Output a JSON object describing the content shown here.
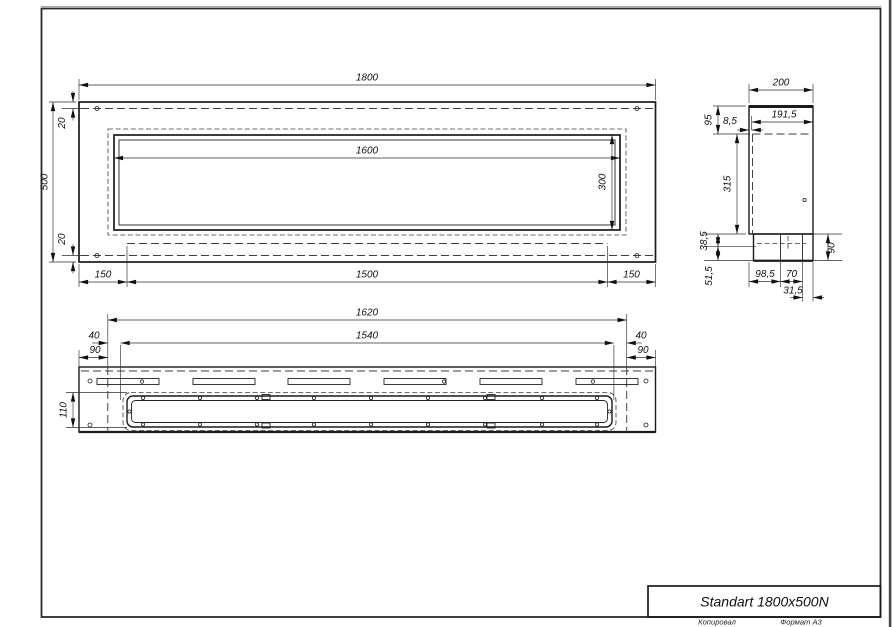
{
  "drawing": {
    "front_view": {
      "overall_width": "1800",
      "overall_height": "500",
      "opening_width": "1600",
      "opening_height": "300",
      "top_inset": "20",
      "bottom_inset": "20",
      "left_margin": "150",
      "center_span": "1500",
      "right_margin": "150"
    },
    "side_view": {
      "depth": "200",
      "inner_depth": "191,5",
      "front_lip": "8,5",
      "top_section": "95",
      "middle_section": "315",
      "ledge_height": "38,5",
      "base_height": "51,5",
      "tray_height": "90",
      "base_a": "98,5",
      "base_b": "70",
      "base_c": "31,5"
    },
    "bottom_view": {
      "mount_width": "1620",
      "inner_width": "1540",
      "left_offset": "40",
      "left_cap": "90",
      "right_offset": "40",
      "right_cap": "90",
      "tray_depth": "110"
    },
    "title_block": {
      "title": "Standart 1800x500N",
      "footer_copy": "Копировал",
      "footer_format": "Формат А3"
    }
  },
  "colors": {
    "line": "#1b1b1b",
    "background": "#ffffff",
    "window_edge": "#4a4a4a"
  }
}
